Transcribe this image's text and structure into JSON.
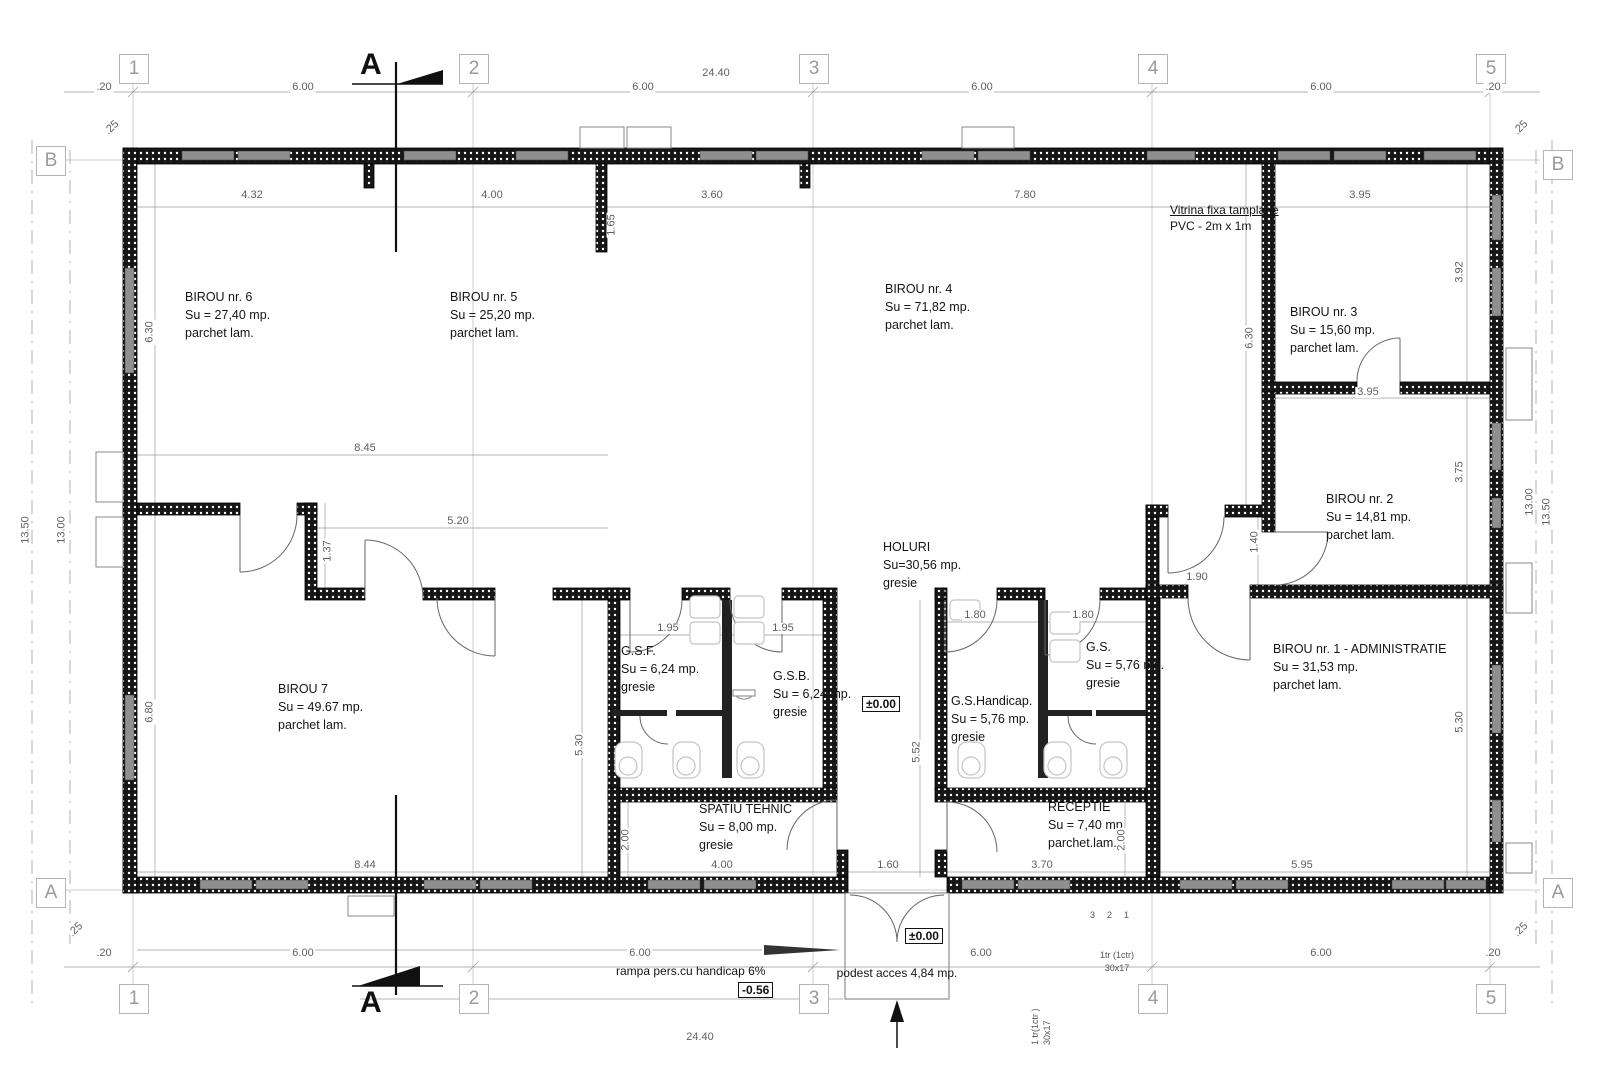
{
  "grid": {
    "cols": [
      "1",
      "2",
      "3",
      "4",
      "5"
    ],
    "row_top": "B",
    "row_bottom": "A",
    "section": "A"
  },
  "rooms": [
    {
      "name": "BIROU nr. 6",
      "area": "Su = 27,40 mp.",
      "finish": "parchet lam."
    },
    {
      "name": "BIROU nr. 5",
      "area": "Su = 25,20 mp.",
      "finish": "parchet lam."
    },
    {
      "name": "BIROU nr. 4",
      "area": "Su = 71,82 mp.",
      "finish": "parchet lam."
    },
    {
      "name": "BIROU nr. 3",
      "area": "Su = 15,60 mp.",
      "finish": "parchet lam."
    },
    {
      "name": "BIROU nr. 2",
      "area": "Su = 14,81 mp.",
      "finish": "parchet lam."
    },
    {
      "name": "BIROU nr. 1 - ADMINISTRATIE",
      "area": "Su = 31,53 mp.",
      "finish": "parchet lam."
    },
    {
      "name": "BIROU 7",
      "area": "Su = 49.67 mp.",
      "finish": "parchet lam."
    },
    {
      "name": "HOLURI",
      "area": "Su=30,56 mp.",
      "finish": "gresie"
    },
    {
      "name": "G.S.F.",
      "area": "Su = 6,24 mp.",
      "finish": "gresie"
    },
    {
      "name": "G.S.B.",
      "area": "Su = 6,24 mp.",
      "finish": "gresie"
    },
    {
      "name": "G.S.Handicap.",
      "area": "Su = 5,76 mp.",
      "finish": "gresie"
    },
    {
      "name": "G.S.",
      "area": "Su = 5,76 mp.",
      "finish": "gresie"
    },
    {
      "name": "SPATIU TEHNIC",
      "area": "Su = 8,00 mp.",
      "finish": "gresie"
    },
    {
      "name": "RECEPTIE",
      "area": "Su = 7,40 mp.",
      "finish": "parchet.lam."
    }
  ],
  "levels": {
    "zero": "±0.00",
    "minus": "-0.56"
  },
  "notes": {
    "vitrina_1": "Vitrina fixa tamplarie",
    "vitrina_2": "PVC - 2m x 1m",
    "rampa": "rampa pers.cu handicap 6%",
    "podest": "podest acces 4,84 mp.",
    "stair_h1": "1tr (1ctr)",
    "stair_h2": "30x17",
    "stair_v1": "1 tr(1ctr )",
    "stair_v2": "30x17",
    "step_3": "3",
    "step_2": "2",
    "step_1": "1"
  },
  "dims": {
    "m20_tl": ".20",
    "c12_t": "6.00",
    "c23_t": "6.00",
    "c34_t": "6.00",
    "c45_t": "6.00",
    "m20_tr": ".20",
    "total_t": "24.40",
    "c25_tl": ".25",
    "c25_tr": ".25",
    "c25_bl": ".25",
    "c25_br": ".25",
    "iw_432": "4.32",
    "iw_400": "4.00",
    "iw_165": "1.65",
    "iw_360": "3.60",
    "iw_780": "7.80",
    "iw_395": "3.95",
    "b3_395": "3.95",
    "lh_630": "6.30",
    "lh_680": "6.80",
    "l_1300": "13.00",
    "l_1350": "13.50",
    "rh_392": "3.92",
    "rh_375": "3.75",
    "rh_530": "5.30",
    "r_1300": "13.00",
    "r_1350": "13.50",
    "b4_630": "6.30",
    "m_845": "8.45",
    "m_520": "5.20",
    "m_137": "1.37",
    "h_190": "1.90",
    "h_140": "1.40",
    "gsf_195": "1.95",
    "gsb_195": "1.95",
    "gsh_180": "1.80",
    "gs_180": "1.80",
    "v_530": "5.30",
    "v_552": "5.52",
    "st_200": "2.00",
    "rec_200": "2.00",
    "b_844": "8.44",
    "b_400": "4.00",
    "b_160": "1.60",
    "b_370": "3.70",
    "b_595": "5.95",
    "m20_bl": ".20",
    "c12_b": "6.00",
    "c23_b": "6.00",
    "c34_b": "6.00",
    "c45_b": "6.00",
    "m20_br": ".20",
    "total_b": "24.40"
  }
}
